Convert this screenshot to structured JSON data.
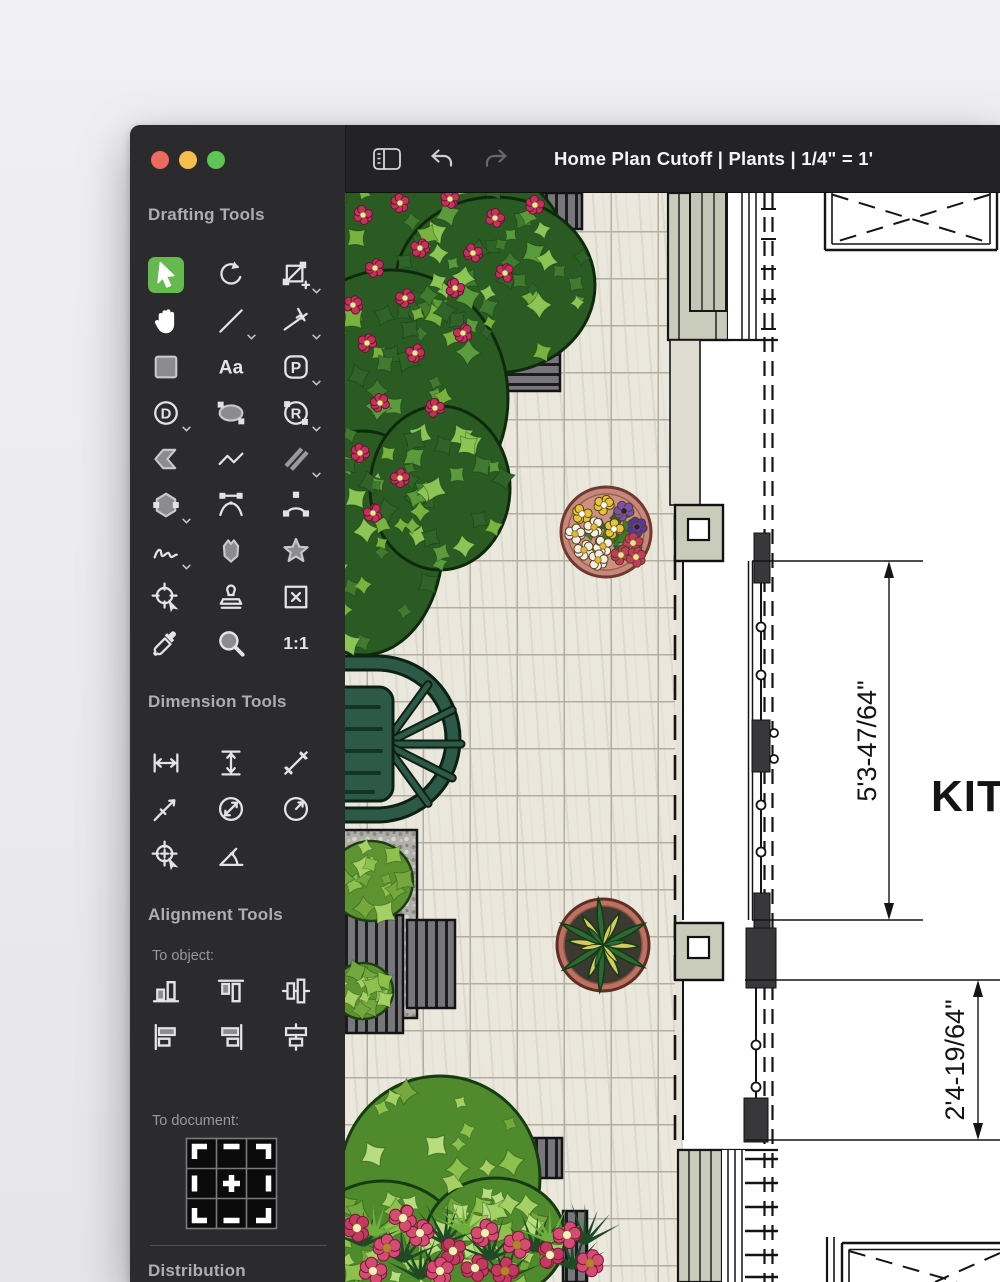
{
  "window": {
    "title": "Home Plan Cutoff | Plants | 1/4\" = 1'",
    "traffic_lights": [
      "close",
      "minimize",
      "zoom"
    ]
  },
  "titlebar": {
    "icons": [
      "sidebar-toggle",
      "undo",
      "redo"
    ]
  },
  "sidebar": {
    "sections": {
      "drafting": {
        "title": "Drafting Tools"
      },
      "dimension": {
        "title": "Dimension Tools"
      },
      "alignment": {
        "title": "Alignment Tools"
      },
      "distribution": {
        "title": "Distribution"
      }
    },
    "labels": {
      "to_object": "To object:",
      "to_document": "To document:"
    },
    "drafting_tools": [
      {
        "name": "select",
        "icon": "select",
        "selected": true
      },
      {
        "name": "rotate",
        "icon": "rotate"
      },
      {
        "name": "transform",
        "icon": "transform",
        "variant": true
      },
      {
        "name": "pan-hand",
        "icon": "hand"
      },
      {
        "name": "line",
        "icon": "line",
        "variant": true
      },
      {
        "name": "constrained-line",
        "icon": "constr-line",
        "variant": true
      },
      {
        "name": "rectangle",
        "icon": "rect"
      },
      {
        "name": "text",
        "icon": "text",
        "label": "Aa"
      },
      {
        "name": "parametric-shape",
        "icon": "pshape",
        "label": "P",
        "variant": true
      },
      {
        "name": "dynamic-shape",
        "icon": "dcircle",
        "label": "D",
        "variant": true
      },
      {
        "name": "ellipse",
        "icon": "ellipse"
      },
      {
        "name": "rounded-shape",
        "icon": "rcircle",
        "label": "R",
        "variant": true
      },
      {
        "name": "arrow-shape",
        "icon": "arrow-shape"
      },
      {
        "name": "polyline",
        "icon": "polyline"
      },
      {
        "name": "double-line",
        "icon": "dblline",
        "variant": true
      },
      {
        "name": "polygon",
        "icon": "hexagon",
        "variant": true
      },
      {
        "name": "bezier-curve",
        "icon": "bezier"
      },
      {
        "name": "arc",
        "icon": "arc"
      },
      {
        "name": "freehand",
        "icon": "freehand",
        "variant": true
      },
      {
        "name": "blob",
        "icon": "blob"
      },
      {
        "name": "star",
        "icon": "star"
      },
      {
        "name": "snap-target",
        "icon": "snap"
      },
      {
        "name": "stamp",
        "icon": "stamp"
      },
      {
        "name": "placeholder-box",
        "icon": "boxx"
      },
      {
        "name": "eyedropper",
        "icon": "dropper"
      },
      {
        "name": "zoom",
        "icon": "magnifier"
      },
      {
        "name": "actual-size",
        "icon": "onetoone",
        "label": "1:1"
      }
    ],
    "dimension_tools": [
      {
        "name": "dim-horizontal",
        "icon": "dim-h"
      },
      {
        "name": "dim-vertical",
        "icon": "dim-v"
      },
      {
        "name": "dim-diagonal",
        "icon": "dim-diag"
      },
      {
        "name": "dim-offset",
        "icon": "dim-offset"
      },
      {
        "name": "dim-diameter",
        "icon": "dim-diameter"
      },
      {
        "name": "dim-radius",
        "icon": "dim-radius"
      },
      {
        "name": "dim-center-mark",
        "icon": "dim-center"
      },
      {
        "name": "dim-angle",
        "icon": "dim-angle"
      }
    ],
    "align_object_tools": [
      {
        "name": "align-bottom",
        "icon": "al-bottom"
      },
      {
        "name": "align-top",
        "icon": "al-top"
      },
      {
        "name": "align-middle",
        "icon": "al-middle"
      },
      {
        "name": "align-left",
        "icon": "al-left"
      },
      {
        "name": "align-right",
        "icon": "al-right"
      },
      {
        "name": "align-center",
        "icon": "al-center"
      }
    ]
  },
  "canvas": {
    "room_label": "KITC",
    "dimensions": [
      {
        "label": "5'3-47/64\""
      },
      {
        "label": "2'4-19/64\""
      }
    ]
  },
  "colors": {
    "accent_green": "#66b94e",
    "sidebar_bg": "#2b2b2d",
    "titlebar_bg": "#232326",
    "tile": "#eae7dd",
    "sage_siding": "#c9ccba",
    "terracotta": "#c6887c",
    "chair_green": "#2d5a47",
    "flower_crimson": "#c5305f"
  }
}
